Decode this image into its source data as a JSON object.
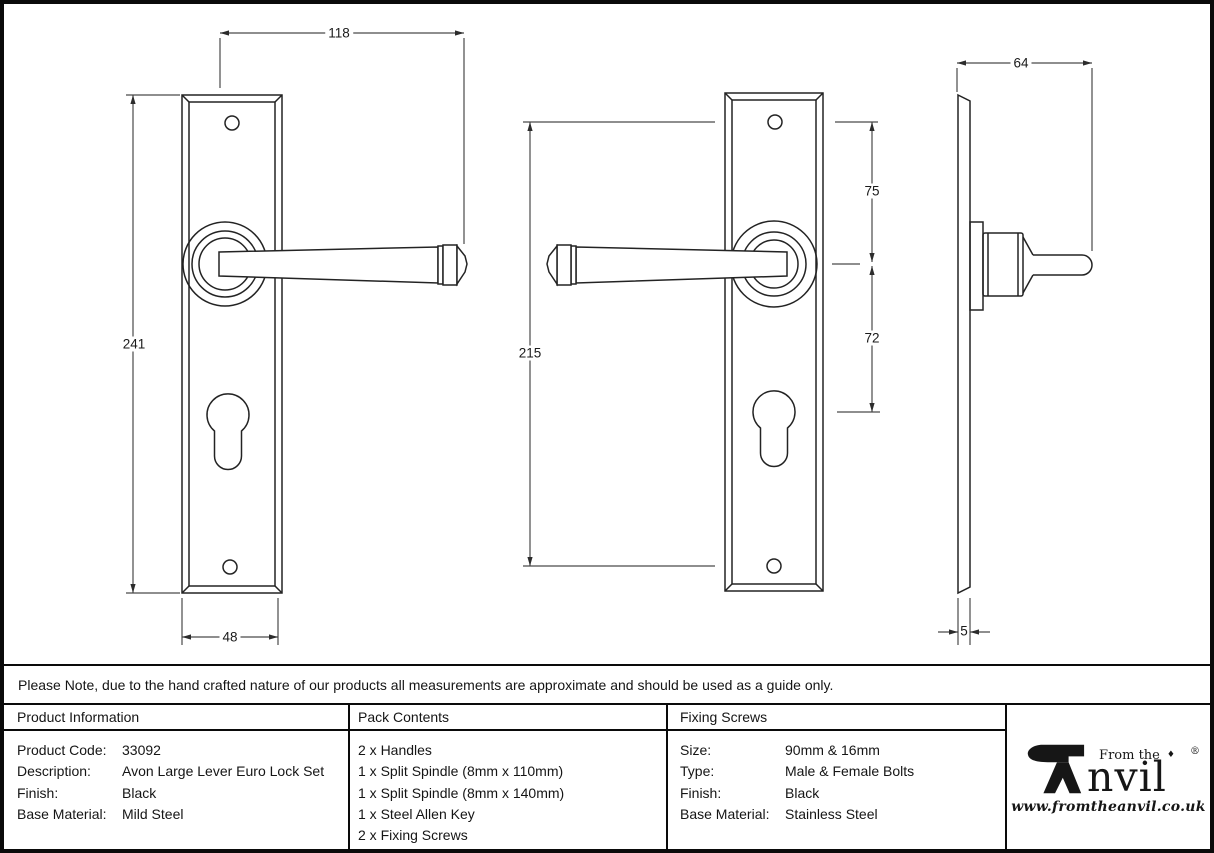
{
  "note": "Please Note, due to the hand crafted nature of our products all measurements are approximate and should be used as a guide only.",
  "dimensions": {
    "front_width": "118",
    "front_height": "241",
    "plate_width": "48",
    "fixing_centres": "215",
    "top_to_handle": "75",
    "handle_to_euro": "72",
    "projection": "64",
    "plate_thickness": "5"
  },
  "table": {
    "product_info": {
      "header": "Product Information",
      "rows": [
        {
          "label": "Product Code:",
          "value": "33092"
        },
        {
          "label": "Description:",
          "value": "Avon Large Lever Euro Lock Set"
        },
        {
          "label": "Finish:",
          "value": "Black"
        },
        {
          "label": "Base Material:",
          "value": "Mild Steel"
        }
      ]
    },
    "pack_contents": {
      "header": "Pack Contents",
      "items": [
        "2 x Handles",
        "1 x Split Spindle (8mm x 110mm)",
        "1 x Split Spindle (8mm x 140mm)",
        "1 x Steel Allen Key",
        "2 x Fixing Screws"
      ]
    },
    "fixing_screws": {
      "header": "Fixing Screws",
      "rows": [
        {
          "label": "Size:",
          "value": "90mm & 16mm"
        },
        {
          "label": "Type:",
          "value": "Male & Female Bolts"
        },
        {
          "label": "Finish:",
          "value": "Black"
        },
        {
          "label": "Base Material:",
          "value": "Stainless Steel"
        }
      ]
    }
  },
  "logo": {
    "from_the": "From the",
    "diamond": "♦",
    "name_rest": "nvil",
    "registered": "®",
    "url": "www.fromtheanvil.co.uk"
  },
  "colors": {
    "line": "#232323",
    "dim_line": "#4a4a4a",
    "border": "#0a0a0a",
    "background": "#ffffff",
    "text": "#151515"
  }
}
